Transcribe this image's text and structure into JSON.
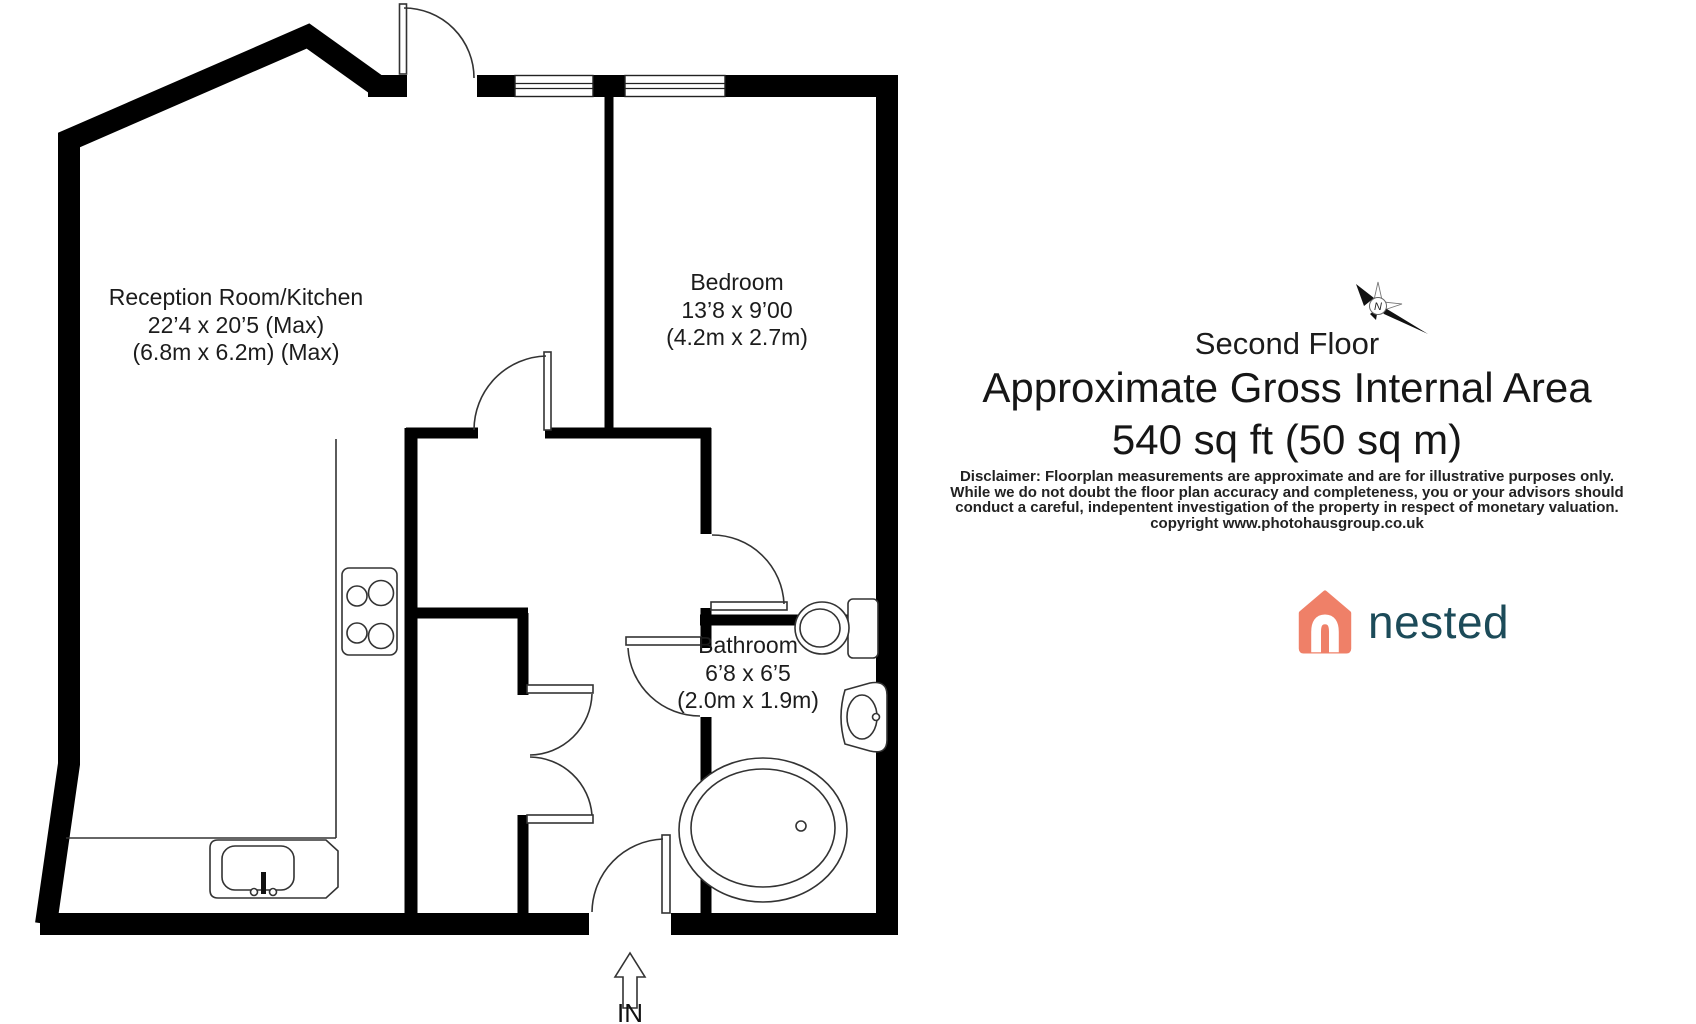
{
  "floorplan": {
    "rooms": [
      {
        "name": "Reception Room/Kitchen",
        "size_imperial": "22’4 x 20’5 (Max)",
        "size_metric": "(6.8m x 6.2m) (Max)"
      },
      {
        "name": "Bedroom",
        "size_imperial": "13’8 x 9’00",
        "size_metric": "(4.2m x 2.7m)"
      },
      {
        "name": "Bathroom",
        "size_imperial": "6’8 x 6’5",
        "size_metric": "(2.0m x 1.9m)"
      }
    ],
    "entrance_label": "IN",
    "compass_letter": "N"
  },
  "info_panel": {
    "floor_name": "Second Floor",
    "area_heading": "Approximate Gross Internal Area",
    "area_value": "540 sq ft (50 sq m)",
    "disclaimer_lines": [
      "Disclaimer: Floorplan measurements are approximate and are for illustrative purposes only.",
      "While we do not doubt the floor plan accuracy and completeness, you or your advisors should",
      "conduct a careful, indepentent investigation of the property in respect of monetary valuation.",
      "copyright www.photohausgroup.co.uk"
    ],
    "brand": {
      "logo_text": "nested",
      "logo_color": "#EF8068",
      "logo_text_color": "#1C4B59"
    }
  }
}
